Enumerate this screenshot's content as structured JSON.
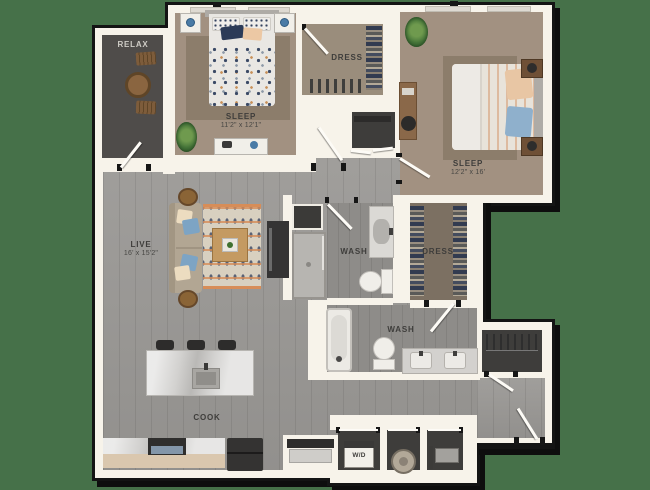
{
  "background_color": "#467149",
  "palette": {
    "wall": "#f7f3ea",
    "outline": "#141414",
    "wood_floor": "#9b9996",
    "carpet_tan": "#a29181",
    "closet_dark": "#3e3d3b",
    "walkin_brown": "#7c7062",
    "balcony_gray": "#4f4c4a",
    "accent_orange": "#d78d58",
    "accent_blue": "#8fb0cc",
    "accent_navy": "#2c3b58"
  },
  "rooms": {
    "relax": {
      "label": "RELAX"
    },
    "sleep1": {
      "label": "SLEEP",
      "dims": "11'2\" x 12'1\""
    },
    "dress1": {
      "label": "DRESS"
    },
    "sleep2": {
      "label": "SLEEP",
      "dims": "12'2\" x 16'"
    },
    "live": {
      "label": "LIVE",
      "dims": "16' x 15'2\""
    },
    "wash1": {
      "label": "WASH"
    },
    "dress2": {
      "label": "DRESS"
    },
    "wash2": {
      "label": "WASH"
    },
    "cook": {
      "label": "COOK"
    },
    "laundry": {
      "label": "W/D"
    }
  }
}
